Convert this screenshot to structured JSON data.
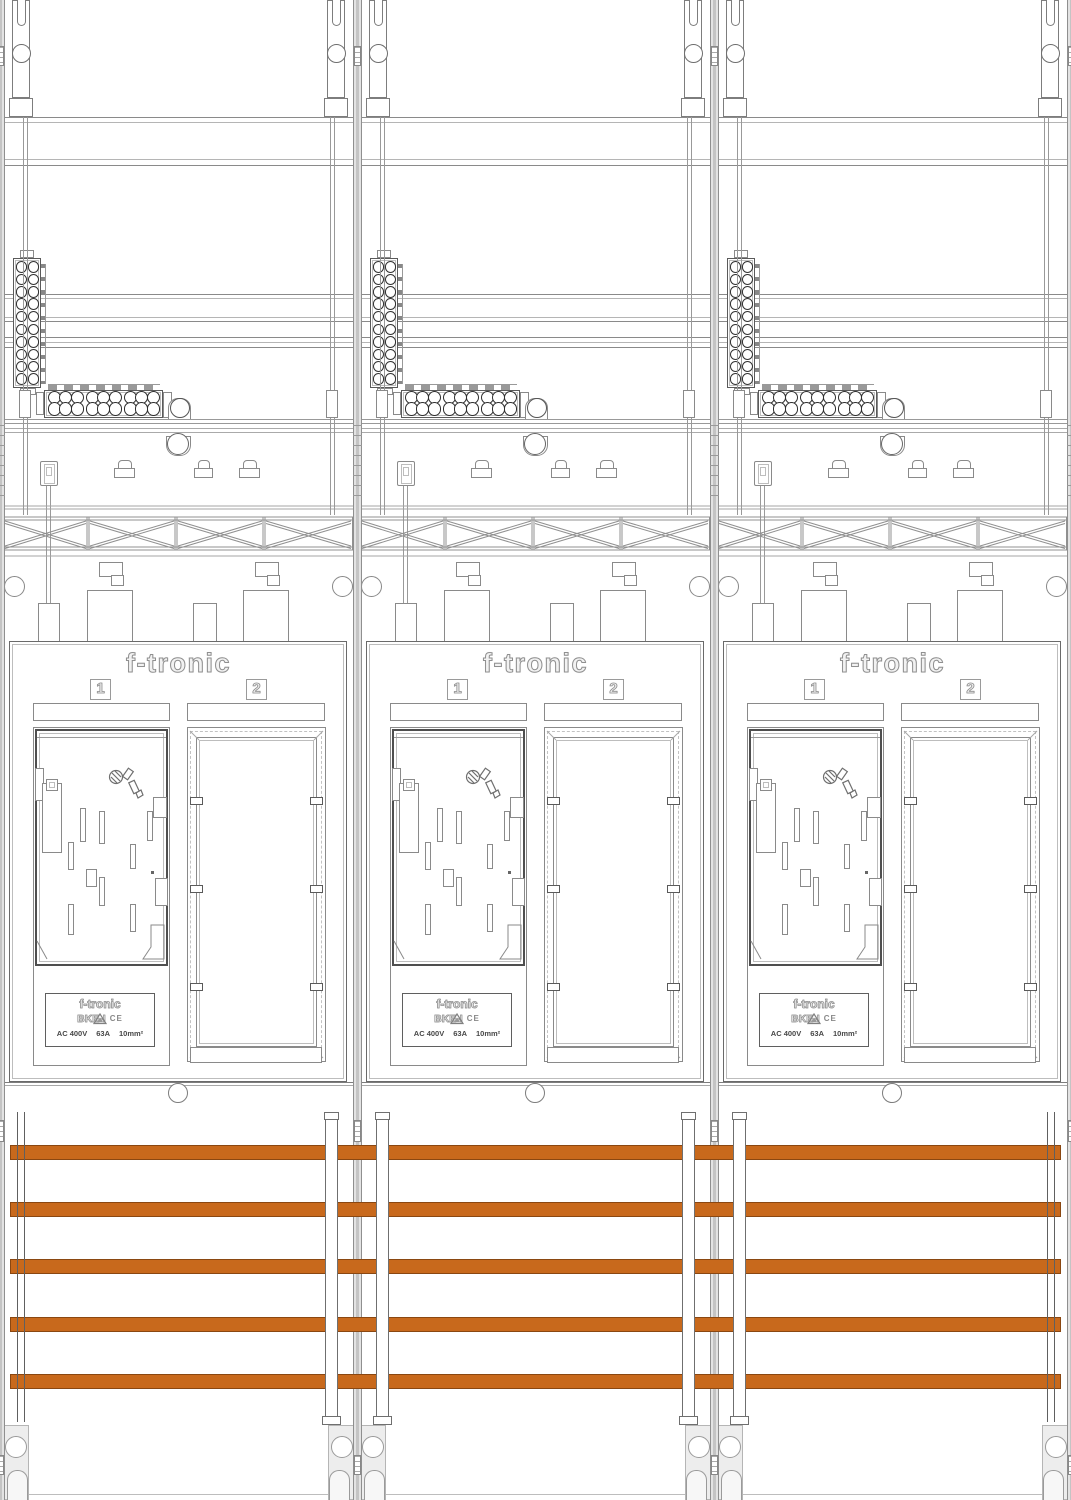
{
  "drawing": {
    "panels_count": 3,
    "panel": {
      "brand": "f-tronic",
      "slot_labels": [
        "1",
        "2"
      ],
      "nameplate": {
        "brand": "f-tronic",
        "model": "BKE-I",
        "certification": "CE",
        "rating_voltage": "AC 400V",
        "rating_current": "63A",
        "rating_wire_size": "10mm²"
      }
    },
    "busbars": {
      "count": 5,
      "color": "#c8691c"
    },
    "icons": {
      "nameplate_logo": "triangle-logo"
    }
  }
}
